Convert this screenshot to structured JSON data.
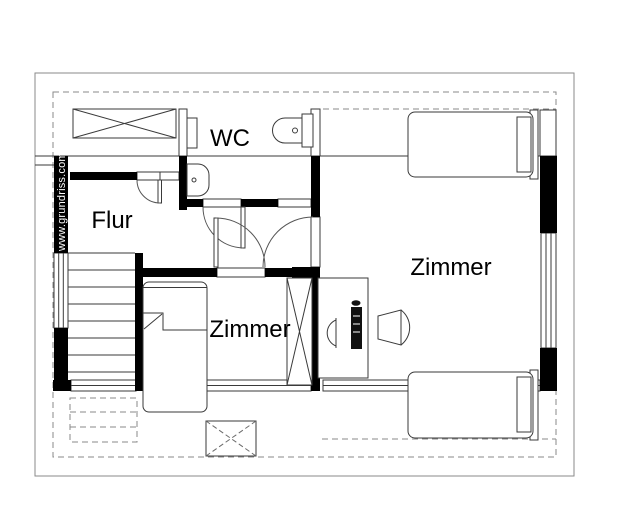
{
  "plan": {
    "watermark": "www.grundriss.com",
    "rooms": [
      {
        "id": "wc",
        "label": "WC"
      },
      {
        "id": "flur",
        "label": "Flur"
      },
      {
        "id": "zimmer-right",
        "label": "Zimmer"
      },
      {
        "id": "zimmer-bottom",
        "label": "Zimmer"
      }
    ],
    "colors": {
      "background": "#ffffff",
      "wall_fill": "#000000",
      "thin_line": "#3a3a3a",
      "roof_line": "#8a8a8a",
      "label_text": "#000000",
      "watermark_text": "#ffffff"
    },
    "symbols": [
      "wardrobe-icon",
      "toilet-icon",
      "sink-icon",
      "bed-icon",
      "desk-icon",
      "computer-icon",
      "chair-icon",
      "stairs-icon",
      "skylight-icon",
      "door-icon",
      "window-icon"
    ]
  }
}
